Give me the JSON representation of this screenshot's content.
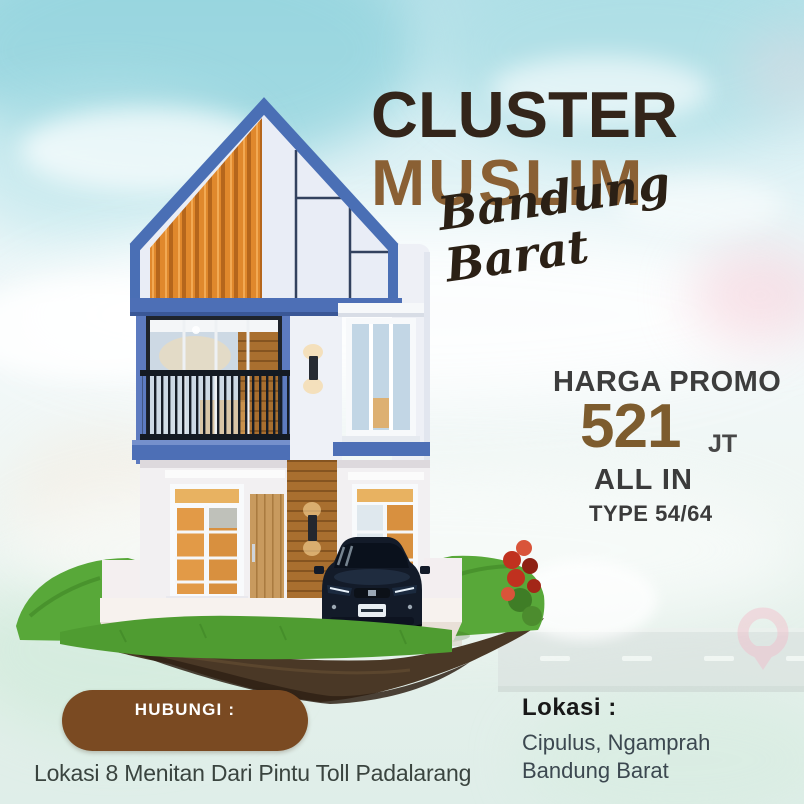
{
  "title": {
    "line1": "CLUSTER",
    "line2": "MUSLIM",
    "tagline": "Bandung Barat"
  },
  "promo": {
    "label": "HARGA PROMO",
    "price_value": "521",
    "price_unit": "JT",
    "all_in": "ALL IN",
    "type": "TYPE 54/64"
  },
  "contact": {
    "button_label": "HUBUNGI :"
  },
  "location": {
    "heading": "Lokasi :",
    "line1": "Cipulus, Ngamprah",
    "line2": "Bandung Barat"
  },
  "footer_note": "Lokasi 8 Menitan Dari Pintu Toll Padalarang",
  "colors": {
    "title_dark": "#33251a",
    "title_brown": "#8a6034",
    "price_brown": "#7d5c2e",
    "button_brown": "#7a4a22",
    "roof_blue": "#4a6fb5",
    "slat_orange": "#e0882c",
    "grass_green": "#58a839"
  },
  "illustration": {
    "scene": "two-story modern house render on a floating grass island with a dark parked car, faint road and pink map-pin watermark"
  }
}
